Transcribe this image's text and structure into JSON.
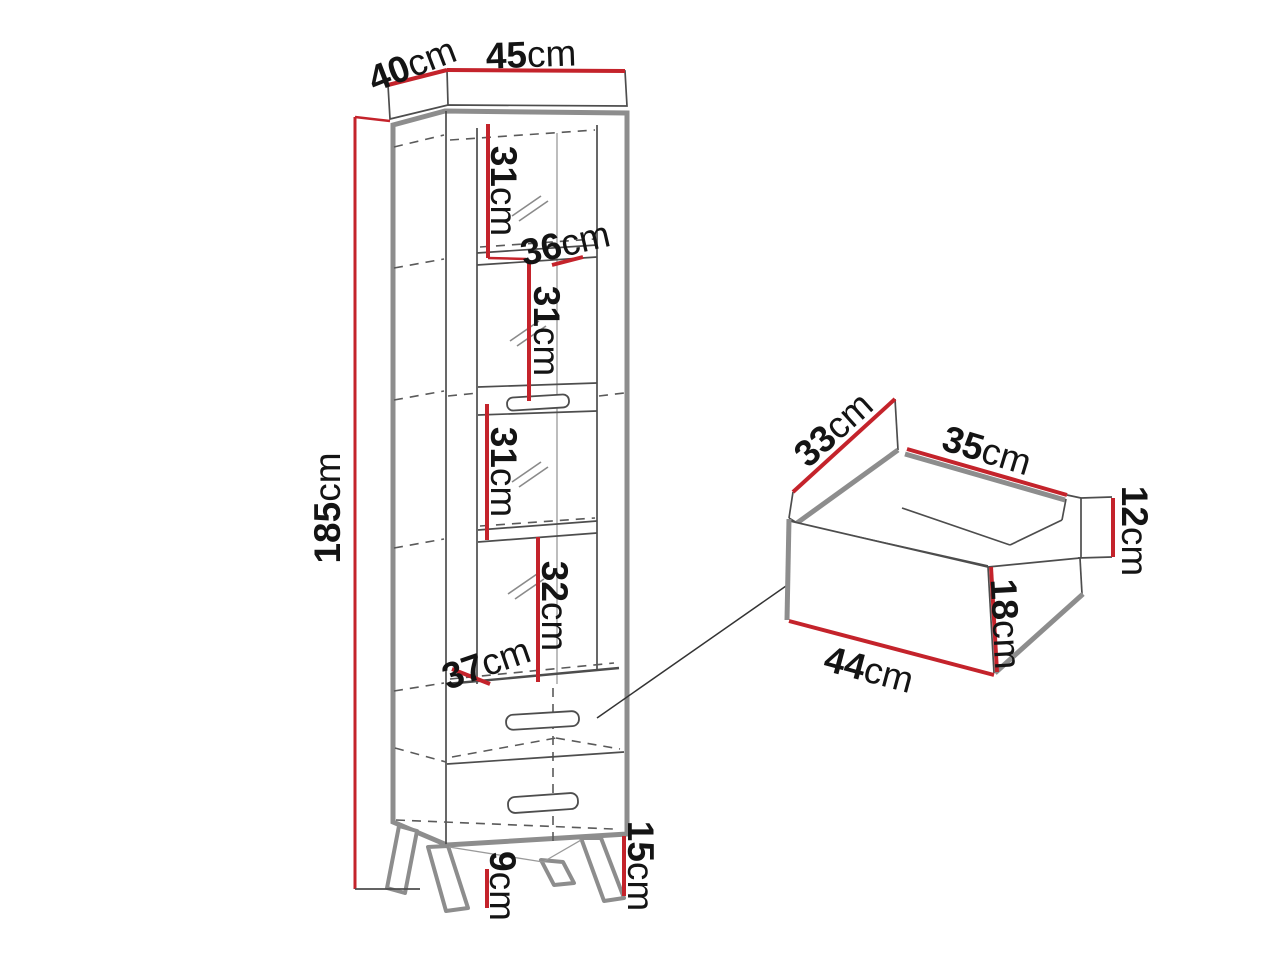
{
  "colors": {
    "background": "#ffffff",
    "dimension_red": "#c4232b",
    "outline_gray": "#8d8d8d",
    "line_dark": "#4d4d4d",
    "text": "#141414"
  },
  "cabinet": {
    "overall": {
      "depth": {
        "value": "40",
        "unit": "cm"
      },
      "width": {
        "value": "45",
        "unit": "cm"
      },
      "height": {
        "value": "185",
        "unit": "cm"
      }
    },
    "interior": {
      "compartment_1_height": {
        "value": "31",
        "unit": "cm"
      },
      "shelf_width_upper": {
        "value": "36",
        "unit": "cm"
      },
      "compartment_2_height": {
        "value": "31",
        "unit": "cm"
      },
      "compartment_3_height": {
        "value": "31",
        "unit": "cm"
      },
      "compartment_4_height": {
        "value": "32",
        "unit": "cm"
      },
      "shelf_width_lower": {
        "value": "37",
        "unit": "cm"
      }
    },
    "base": {
      "leg_height": {
        "value": "9",
        "unit": "cm"
      },
      "plinth_height": {
        "value": "15",
        "unit": "cm"
      }
    }
  },
  "drawer_detail": {
    "depth": {
      "value": "33",
      "unit": "cm"
    },
    "inner_width": {
      "value": "35",
      "unit": "cm"
    },
    "side_height": {
      "value": "12",
      "unit": "cm"
    },
    "front_height": {
      "value": "18",
      "unit": "cm"
    },
    "front_width": {
      "value": "44",
      "unit": "cm"
    }
  }
}
